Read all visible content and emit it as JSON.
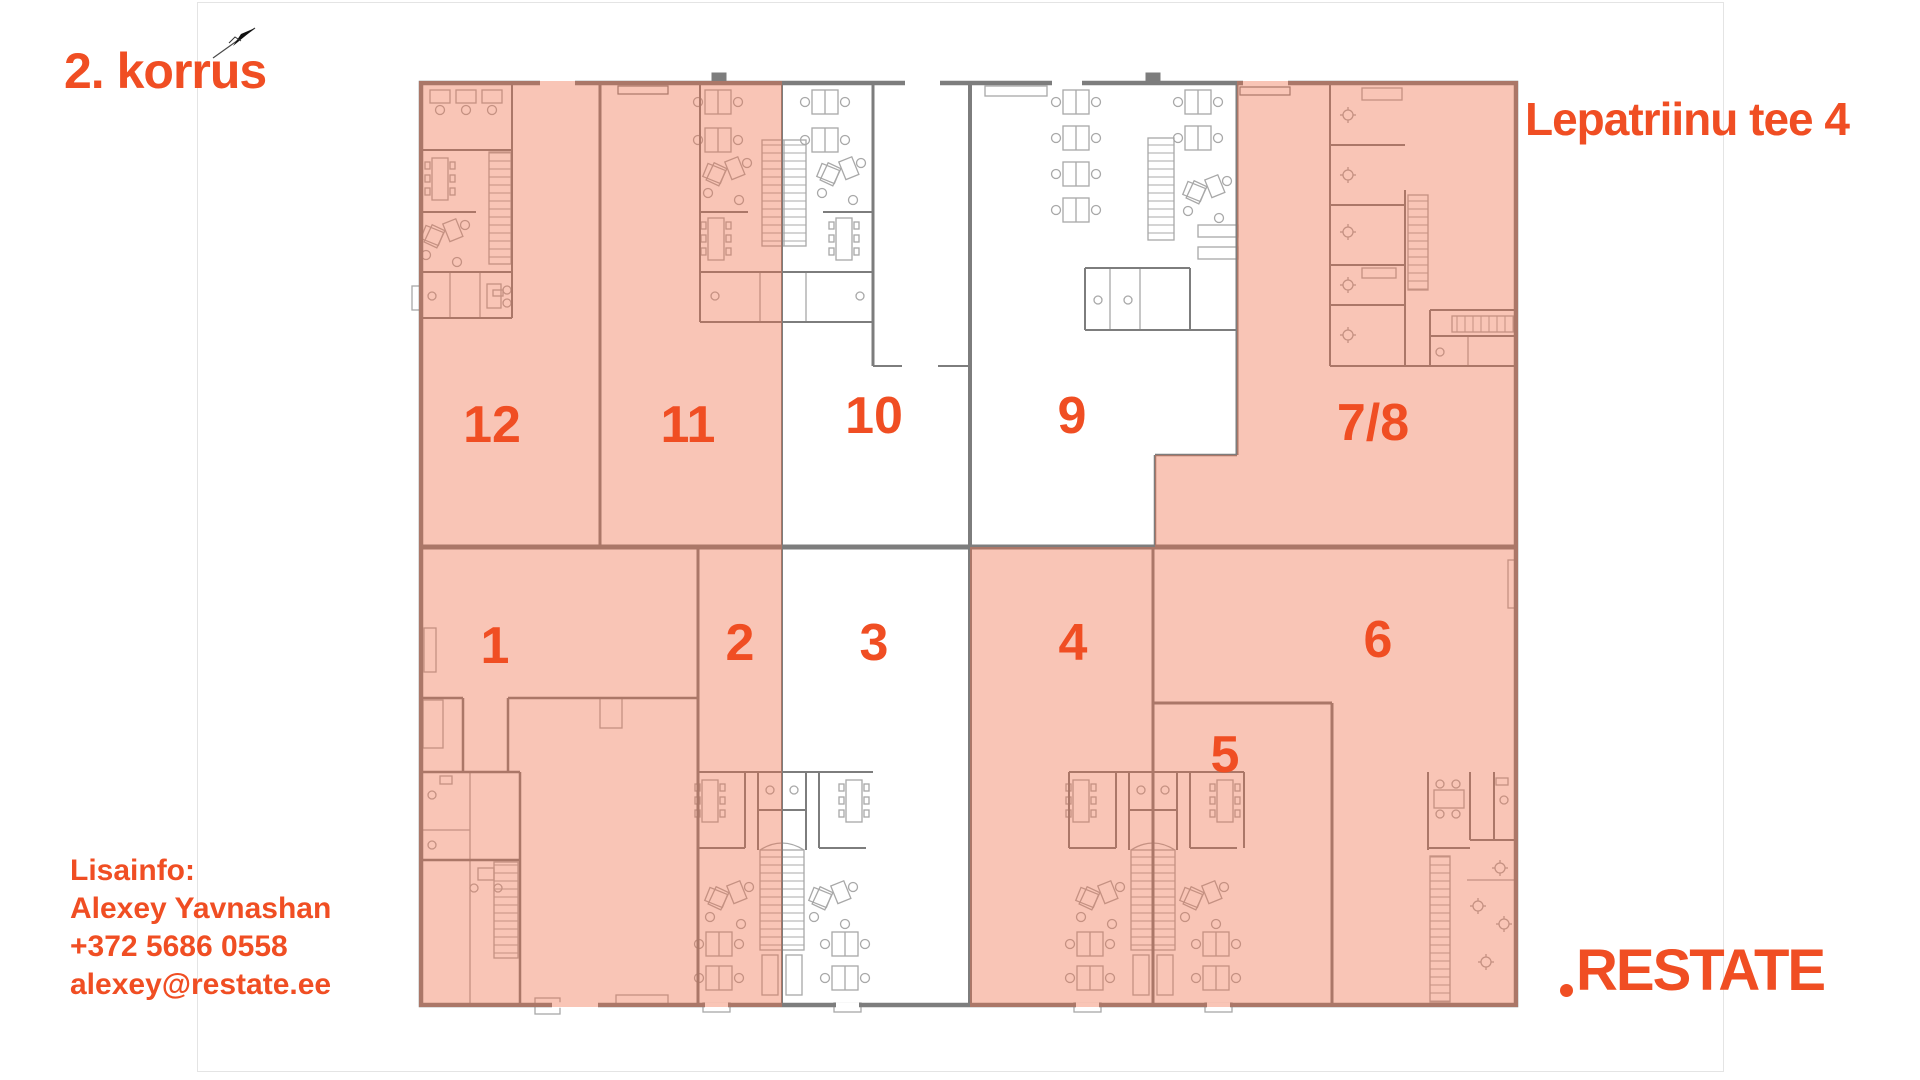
{
  "page": {
    "floor_label": "2. korrus",
    "address": "Lepatriinu tee 4",
    "contact": {
      "heading": "Lisainfo:",
      "name": "Alexey Yavnashan",
      "phone": "+372 5686 0558",
      "email": "alexey@restate.ee"
    },
    "brand": {
      "logo_text": "RESTATE"
    }
  },
  "colors": {
    "accent": "#F04E23",
    "highlight_overlay": "#EF6F48",
    "highlight_opacity": 0.4,
    "wall": "#7D7D7D",
    "furniture_line": "#A8A8A8"
  },
  "floorplan": {
    "units": [
      {
        "id": "u12",
        "label": "12",
        "highlighted": true,
        "label_x": 492,
        "label_y": 425
      },
      {
        "id": "u11",
        "label": "11",
        "highlighted": true,
        "label_x": 688,
        "label_y": 425
      },
      {
        "id": "u10",
        "label": "10",
        "highlighted": false,
        "label_x": 874,
        "label_y": 416
      },
      {
        "id": "u9",
        "label": "9",
        "highlighted": false,
        "label_x": 1072,
        "label_y": 416
      },
      {
        "id": "u78",
        "label": "7/8",
        "highlighted": true,
        "label_x": 1373,
        "label_y": 423
      },
      {
        "id": "u1",
        "label": "1",
        "highlighted": true,
        "label_x": 495,
        "label_y": 646
      },
      {
        "id": "u2",
        "label": "2",
        "highlighted": true,
        "label_x": 740,
        "label_y": 643
      },
      {
        "id": "u3",
        "label": "3",
        "highlighted": false,
        "label_x": 874,
        "label_y": 643
      },
      {
        "id": "u4",
        "label": "4",
        "highlighted": true,
        "label_x": 1073,
        "label_y": 643
      },
      {
        "id": "u5",
        "label": "5",
        "highlighted": true,
        "label_x": 1225,
        "label_y": 755
      },
      {
        "id": "u6",
        "label": "6",
        "highlighted": true,
        "label_x": 1378,
        "label_y": 640
      }
    ]
  }
}
